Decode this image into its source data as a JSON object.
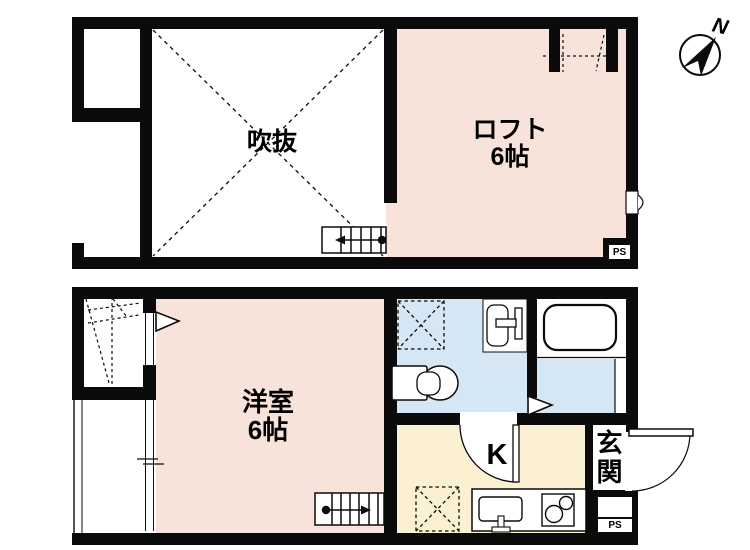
{
  "title": "apartment floor plan",
  "colors": {
    "wall": "#0b0b0b",
    "room_pink": "#f8e3db",
    "wet_blue": "#d5e7f4",
    "kitchen_cream": "#fbf0d2"
  },
  "compass": {
    "label": "N"
  },
  "upper_floor": {
    "rooms": [
      {
        "name": "void",
        "label": "吹抜"
      },
      {
        "name": "loft",
        "label": "ロフト",
        "size": "6帖"
      }
    ],
    "ps_label": "PS"
  },
  "lower_floor": {
    "rooms": [
      {
        "name": "western-room",
        "label": "洋室",
        "size": "6帖"
      },
      {
        "name": "kitchen",
        "label": "K"
      },
      {
        "name": "entrance",
        "label": "玄関"
      }
    ],
    "ps_label": "PS"
  },
  "symbols": [
    "compass-north",
    "stairs-upper",
    "stairs-lower",
    "toilet",
    "washbasin",
    "bathtub",
    "kitchen-sink",
    "stove-2-burner",
    "washer-space-x-box",
    "fridge-space-x-box",
    "door-swing-kitchen",
    "door-swing-entrance",
    "void-x-cross",
    "closet-ladder",
    "loft-hatch",
    "opening-triangle",
    "vent"
  ]
}
